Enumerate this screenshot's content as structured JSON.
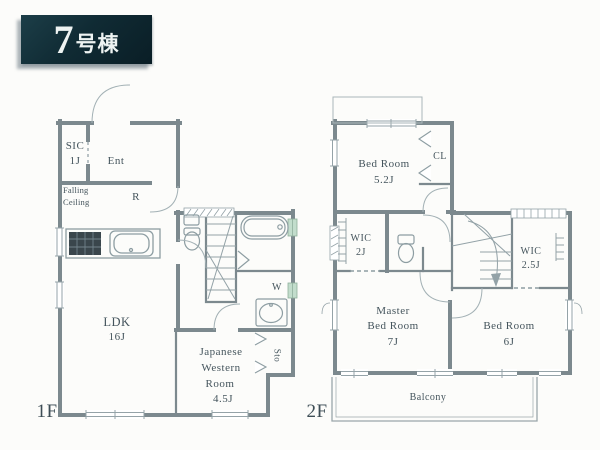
{
  "title_banner": {
    "building_number": "7",
    "unit_suffix": "号棟"
  },
  "floor_1f": {
    "floor_label": "1F",
    "rooms": {
      "sic": {
        "name": "SIC",
        "size": "1J"
      },
      "entrance": {
        "name": "Ent"
      },
      "falling_ceiling_note": {
        "line1": "Falling",
        "line2": "Ceiling"
      },
      "refrigerator_space": {
        "name": "R"
      },
      "ldk": {
        "name": "LDK",
        "size": "16J"
      },
      "japanese_western_room": {
        "line1": "Japanese",
        "line2": "Western",
        "line3": "Room",
        "size": "4.5J"
      },
      "washer_space": {
        "name": "W"
      },
      "storage": {
        "name": "Sto"
      }
    }
  },
  "floor_2f": {
    "floor_label": "2F",
    "rooms": {
      "bedroom_5_2": {
        "name": "Bed Room",
        "size": "5.2J"
      },
      "closet": {
        "name": "CL"
      },
      "wic_2": {
        "name": "WIC",
        "size": "2J"
      },
      "wic_2_5": {
        "name": "WIC",
        "size": "2.5J"
      },
      "master_bedroom": {
        "line1": "Master",
        "line2": "Bed Room",
        "size": "7J"
      },
      "bedroom_6": {
        "name": "Bed Room",
        "size": "6J"
      },
      "balcony": {
        "name": "Balcony"
      }
    }
  },
  "colors": {
    "wall": "#7c898e",
    "thin_line": "#9aa6aa",
    "text": "#44545c",
    "banner_bg": "#102b34",
    "window_highlight": "#c2ddcc",
    "stove_fill": "#3a464c"
  }
}
